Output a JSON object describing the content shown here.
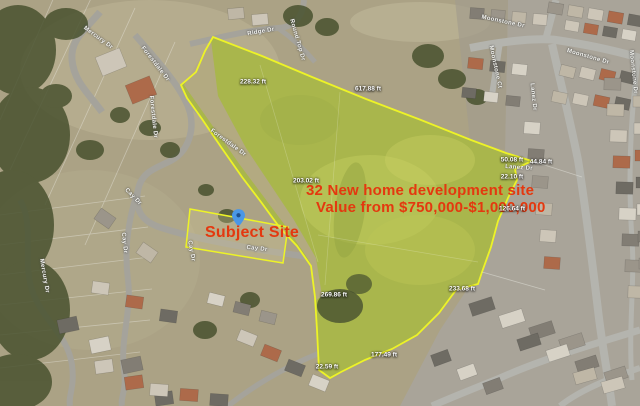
{
  "map": {
    "annotations": {
      "headline": "32 New home development site",
      "value_line": "Value from $750,000-$1,000,000",
      "subject_label": "Subject Site",
      "annotation_color": "#e4380f"
    },
    "marker": {
      "name": "subject-site-pin",
      "fill_color": "#4a97e6",
      "dot_color": "#1d4f8c"
    },
    "parcel": {
      "outline_color": "#edf327",
      "fill_color": "#a9b64c"
    },
    "dimension_labels": [
      {
        "text": "228.32 ft",
        "x": 253,
        "y": 82,
        "rot": 0
      },
      {
        "text": "617.88 ft",
        "x": 368,
        "y": 89,
        "rot": 0
      },
      {
        "text": "203.02 ft",
        "x": 306,
        "y": 181,
        "rot": 0
      },
      {
        "text": "269.86 ft",
        "x": 334,
        "y": 295,
        "rot": 0
      },
      {
        "text": "177.49 ft",
        "x": 384,
        "y": 355,
        "rot": 0
      },
      {
        "text": "22.59 ft",
        "x": 327,
        "y": 367,
        "rot": 0
      },
      {
        "text": "233.68 ft",
        "x": 462,
        "y": 289,
        "rot": 0
      },
      {
        "text": "126.64 ft",
        "x": 512,
        "y": 209,
        "rot": 0
      },
      {
        "text": "50.08 ft",
        "x": 512,
        "y": 160,
        "rot": 0
      },
      {
        "text": "44.84 ft",
        "x": 541,
        "y": 162,
        "rot": 0
      },
      {
        "text": "22.10 ft",
        "x": 512,
        "y": 177,
        "rot": 0
      }
    ],
    "street_labels": [
      {
        "text": "Mercury Dr",
        "x": 98,
        "y": 38,
        "rot": 36
      },
      {
        "text": "Forestdale Dr",
        "x": 155,
        "y": 64,
        "rot": 52
      },
      {
        "text": "Ridge Dr",
        "x": 261,
        "y": 32,
        "rot": -10
      },
      {
        "text": "Round Top Dr",
        "x": 297,
        "y": 40,
        "rot": 74
      },
      {
        "text": "Forestdale Dr",
        "x": 153,
        "y": 117,
        "rot": 84
      },
      {
        "text": "Forestdale Dr",
        "x": 228,
        "y": 143,
        "rot": 36
      },
      {
        "text": "Cay Dr",
        "x": 133,
        "y": 197,
        "rot": 46
      },
      {
        "text": "Cay Dr",
        "x": 124,
        "y": 243,
        "rot": 84
      },
      {
        "text": "Cay Dr",
        "x": 191,
        "y": 251,
        "rot": 80
      },
      {
        "text": "Cay Dr",
        "x": 257,
        "y": 249,
        "rot": 6
      },
      {
        "text": "Mercury Dr",
        "x": 44,
        "y": 276,
        "rot": 80
      },
      {
        "text": "Moonstone Dr",
        "x": 503,
        "y": 22,
        "rot": 12
      },
      {
        "text": "Moonstone Ct",
        "x": 495,
        "y": 67,
        "rot": 78
      },
      {
        "text": "Moonstone Dr",
        "x": 588,
        "y": 57,
        "rot": 16
      },
      {
        "text": "Moonstone Dr",
        "x": 633,
        "y": 72,
        "rot": 84
      },
      {
        "text": "Lanez Dr",
        "x": 533,
        "y": 97,
        "rot": 84
      },
      {
        "text": "Lanez Dr",
        "x": 519,
        "y": 168,
        "rot": 4
      }
    ]
  }
}
